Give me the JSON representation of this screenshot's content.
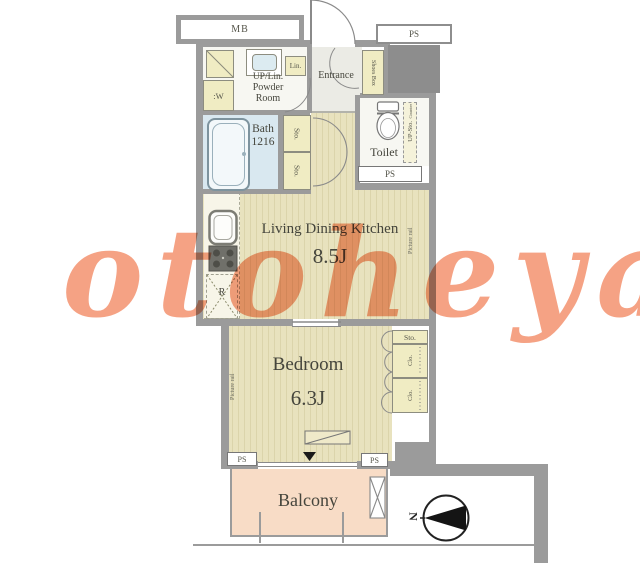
{
  "watermark": "otoheya",
  "floorplan": {
    "meter_box_label": "MB",
    "pipe_space": {
      "top_right": "PS",
      "toilet": "PS",
      "bottom_left": "PS",
      "bottom_right": "PS"
    },
    "powder_room": {
      "label_line1": "UP/Lin.",
      "label_line2": "Powder",
      "label_line3": "Room",
      "linen_label": "Lin.",
      "washer_label": ":W"
    },
    "entrance": {
      "label": "Entrance",
      "shoes_box_label": "Shoes Box"
    },
    "bath": {
      "label": "Bath",
      "size": "1216"
    },
    "hallway": {
      "storage1_label": "Sto.",
      "storage2_label": "Sto."
    },
    "toilet": {
      "label": "Toilet",
      "upper_storage_label": "UP-Sto.",
      "counter_label": "Counter"
    },
    "living_dining_kitchen": {
      "label": "Living Dining Kitchen",
      "size": "8.5J",
      "refrigerator_label": "R",
      "picture_rail_label": "Picture rail"
    },
    "bedroom": {
      "label": "Bedroom",
      "size": "6.3J",
      "picture_rail_label": "Picture rail",
      "closet_top_label": "Sto.",
      "closet1_label": "Clo.",
      "closet2_label": "Clo."
    },
    "balcony": {
      "label": "Balcony"
    },
    "compass": {
      "north_label": "N"
    },
    "colors": {
      "wall": "#9B9B9B",
      "wood_floor": "#E8E2BE",
      "bath_floor": "#D9E8F0",
      "fixture_fill": "#F0ECC3",
      "balcony_floor": "#F8DCC6",
      "watermark": "#F5A284"
    }
  }
}
